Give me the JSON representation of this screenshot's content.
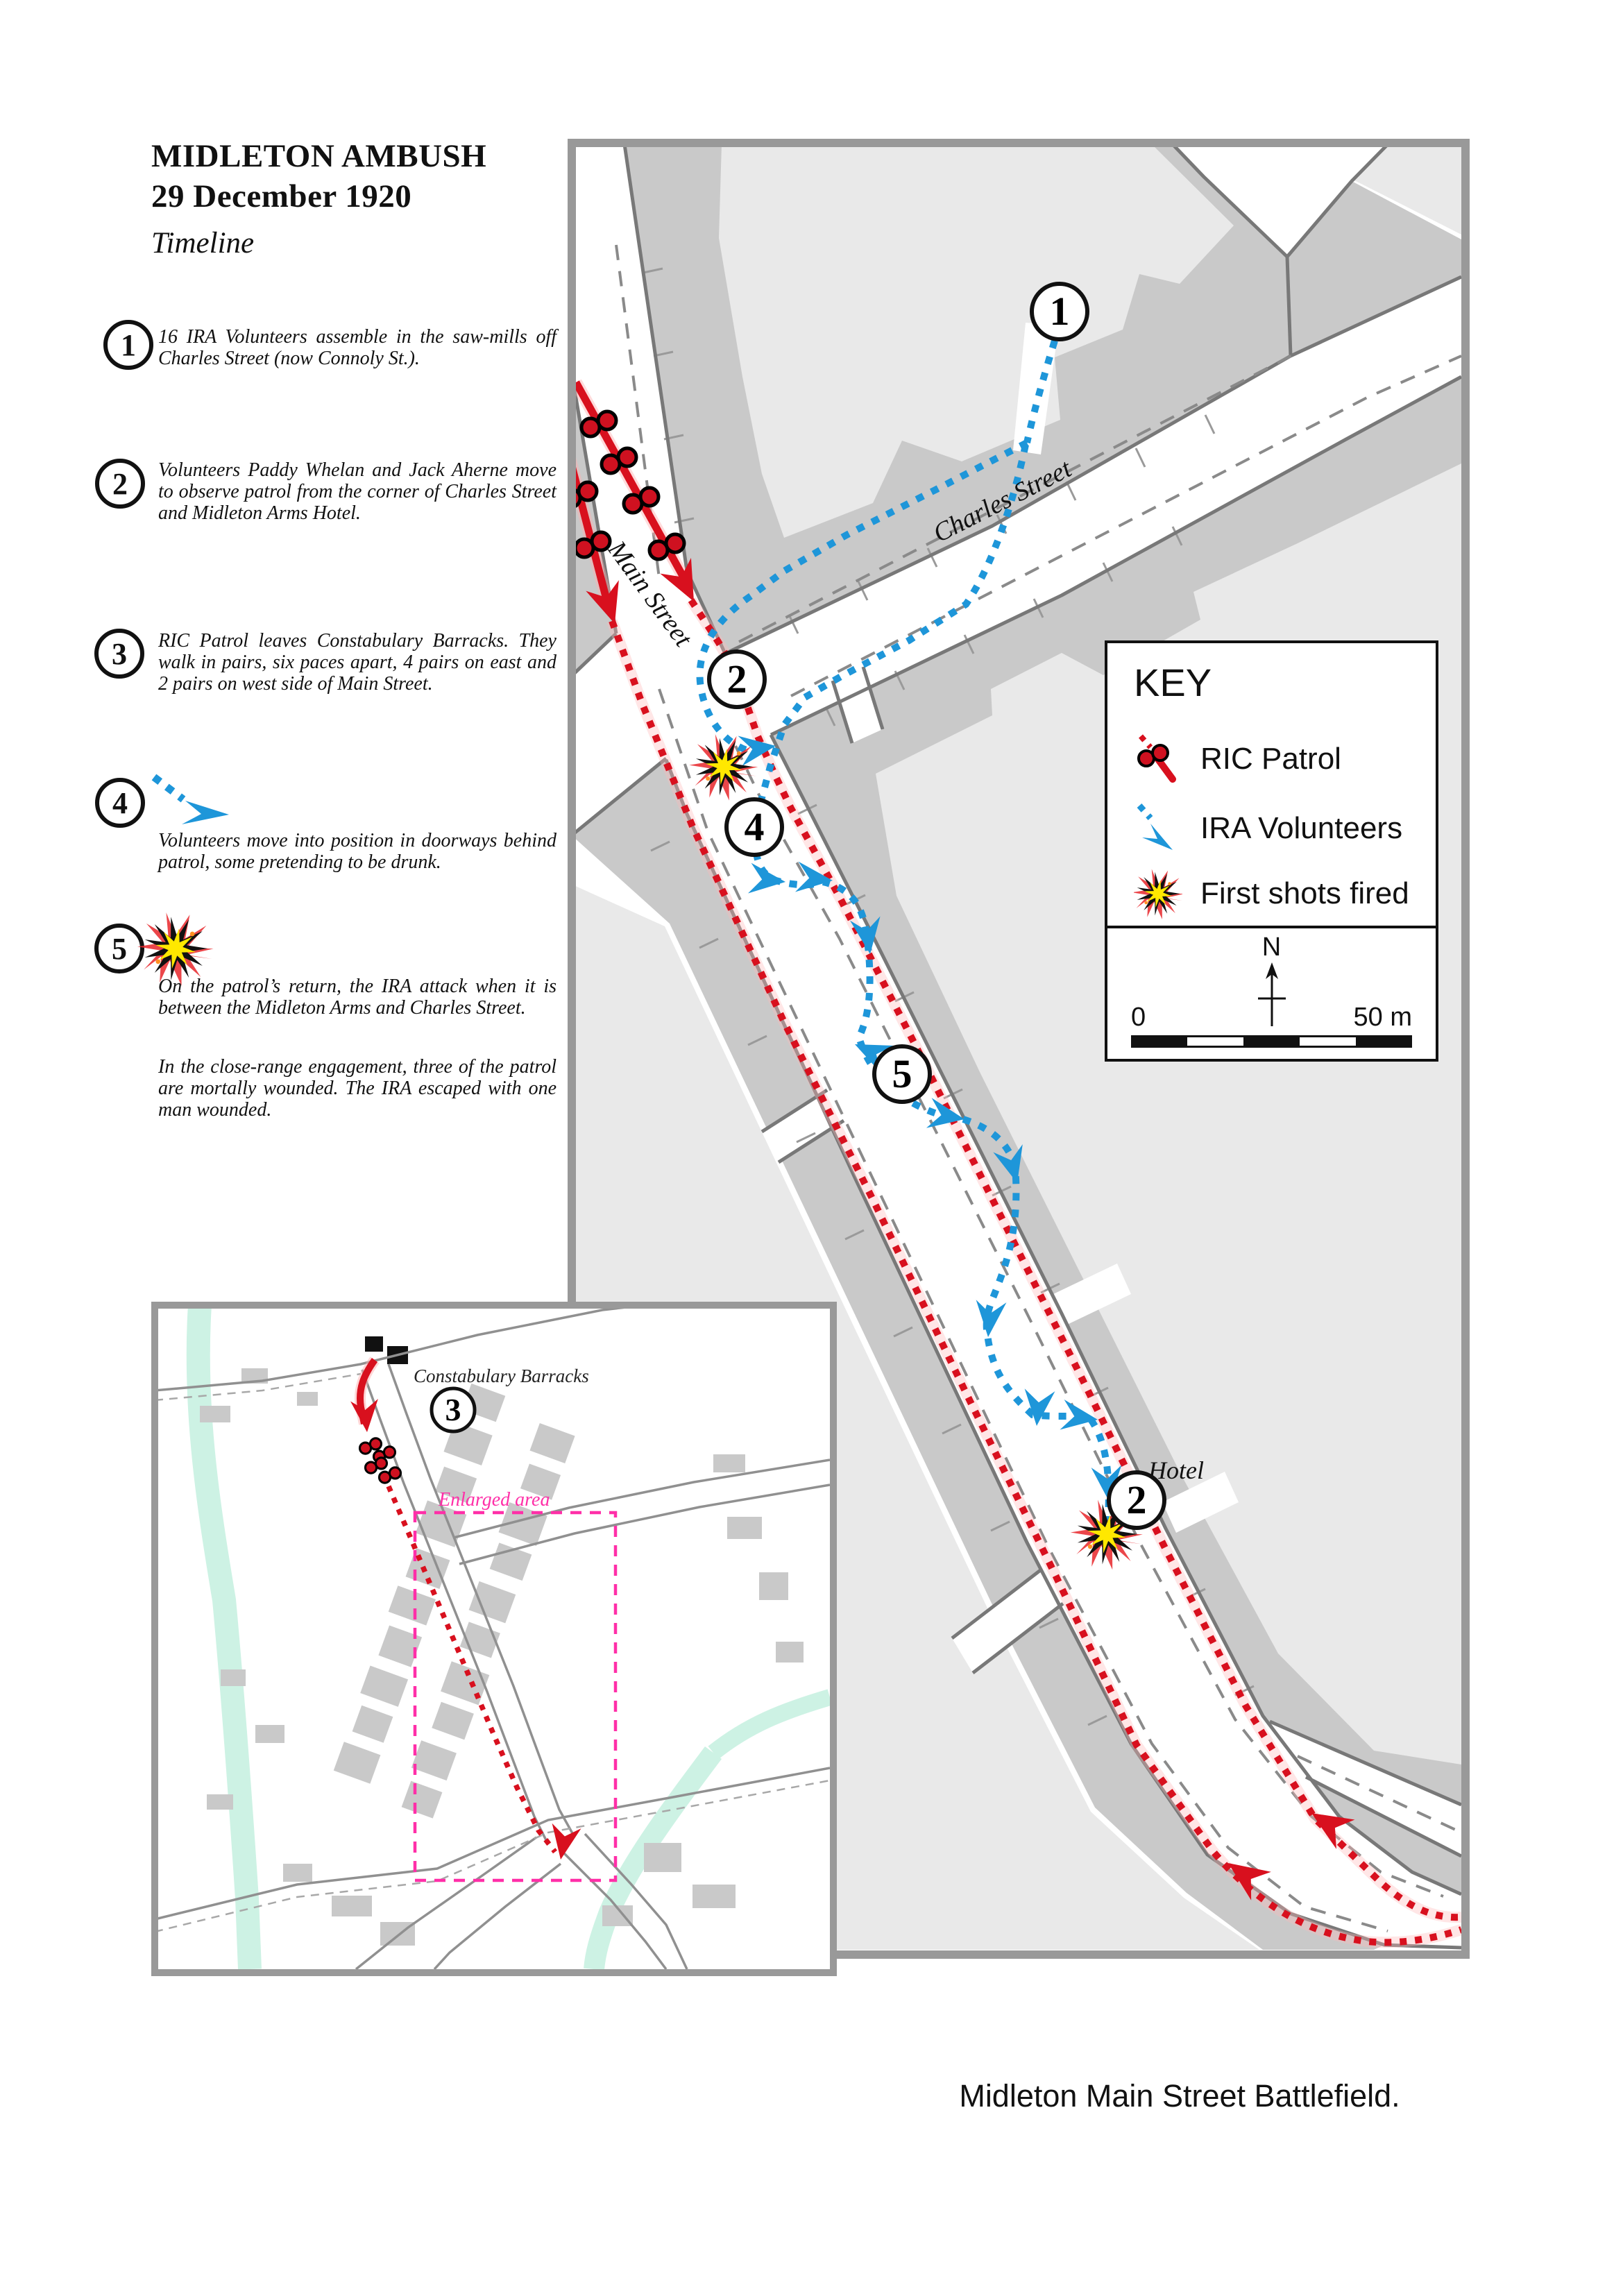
{
  "title": {
    "line1": "MIDLETON AMBUSH",
    "line2": "29 December 1920",
    "line3": "Timeline"
  },
  "timeline": {
    "item1": {
      "num": "1",
      "text": "16   IRA Volunteers assemble in the saw-mills off Charles Street (now Connoly St.)."
    },
    "item2": {
      "num": "2",
      "text": "Volunteers Paddy Whelan and Jack Aherne move to observe patrol from the corner of Charles Street and Midleton Arms Hotel."
    },
    "item3": {
      "num": "3",
      "text": "RIC Patrol leaves Constabulary Barracks. They walk in pairs, six paces apart, 4 pairs on east and 2 pairs on west side of Main Street."
    },
    "item4": {
      "num": "4",
      "text": "Volunteers move into position in doorways behind patrol, some pretending to be drunk."
    },
    "item5": {
      "num": "5",
      "text": "On the patrol’s return, the IRA attack when it is between the Midleton Arms and Charles Street.",
      "text2": "In the close-range engagement, three of the patrol are mortally wounded. The IRA escaped with one man wounded."
    }
  },
  "key": {
    "title": "KEY",
    "ric_label": "RIC Patrol",
    "ira_label": "IRA Volunteers",
    "shots_label": "First shots fired",
    "north": "N",
    "scale_left": "0",
    "scale_right": "50 m"
  },
  "map": {
    "main_street": "Main Street",
    "charles_street": "Charles Street",
    "hotel": "Hotel",
    "marker1": "1",
    "marker2": "2",
    "marker4": "4",
    "marker5": "5"
  },
  "inset": {
    "constabulary": "Constabulary Barracks",
    "enlarged": "Enlarged area",
    "marker3": "3"
  },
  "caption": "Midleton Main Street Battlefield.",
  "colors": {
    "patrol_red": "#d8101e",
    "ira_blue": "#1e96d9",
    "burst_yellow": "#ffe800",
    "enlarged_pink": "#ff2fa8",
    "building_dark": "#c9c9c9",
    "building_light": "#e9e9e9"
  }
}
